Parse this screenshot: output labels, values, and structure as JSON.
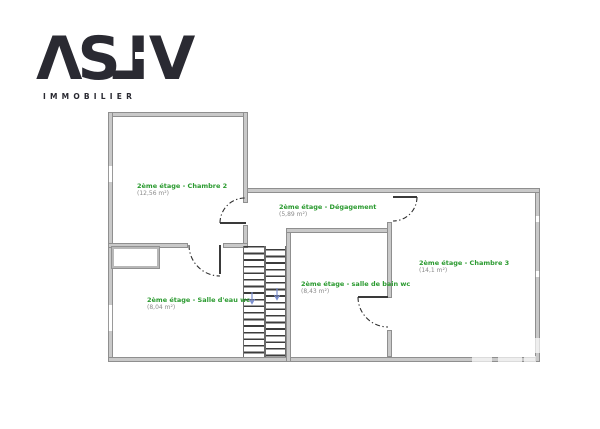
{
  "logo": {
    "name": "ASLV",
    "glyphs": [
      "Λ",
      "S",
      "L",
      "V"
    ],
    "subtitle": "IMMOBILIER",
    "color": "#2a2a32"
  },
  "floorplan": {
    "floor": "2ème étage",
    "rooms": [
      {
        "id": "chambre-2",
        "label": "2ème étage - Chambre 2",
        "area": "(12,56 m²)"
      },
      {
        "id": "degagement",
        "label": "2ème étage - Dégagement",
        "area": "(5,89 m²)"
      },
      {
        "id": "chambre-3",
        "label": "2ème étage - Chambre 3",
        "area": "(14,1 m²)"
      },
      {
        "id": "salle-deau-wc",
        "label": "2ème étage - Salle d'eau wc",
        "area": "(8,04 m²)"
      },
      {
        "id": "salle-de-bain-wc",
        "label": "2ème étage - salle de bain wc",
        "area": "(8,43 m²)"
      }
    ],
    "colors": {
      "room_label_green": "#2a9a2f",
      "area_text_gray": "#8a8a8a",
      "wall_fill": "#c9c9c9",
      "wall_edge": "#8f8f8f",
      "door_line": "#3a3a3a",
      "stair_arrow_blue": "#7b8fd0"
    }
  }
}
